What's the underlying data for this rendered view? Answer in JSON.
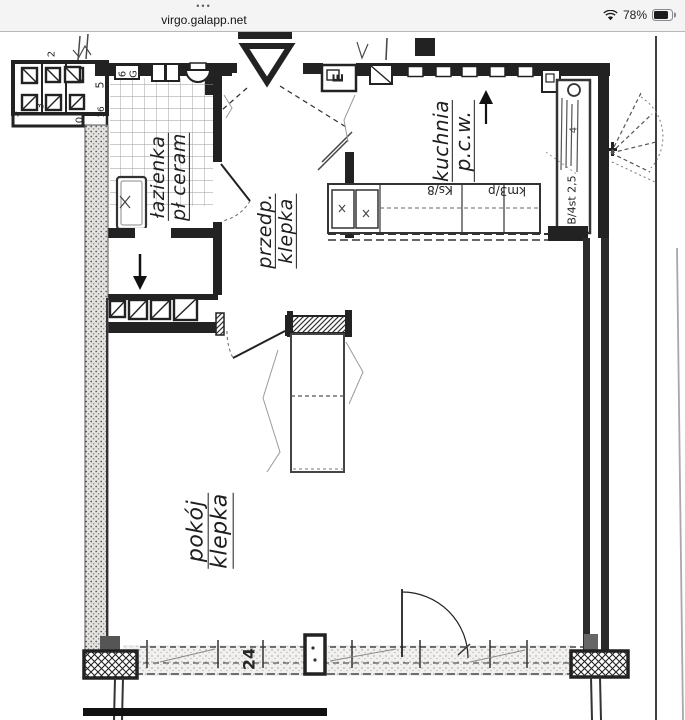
{
  "status_bar": {
    "menu_dots": "•••",
    "url": "virgo.galapp.net",
    "battery_percent": "78%"
  },
  "floor_plan": {
    "rooms": {
      "bathroom": {
        "line1": "łazienka",
        "line2": "pł ceram"
      },
      "hallway": {
        "line1": "przedp.",
        "line2": "klepka"
      },
      "kitchen": {
        "line1": "kuchnia",
        "line2": "p.c.w."
      },
      "living_room": {
        "line1": "pokój",
        "line2": "klepka"
      }
    },
    "annotations": {
      "counter_label_1": "Ks/8",
      "counter_label_2": "km3/p",
      "right_counter_label": "B/4st 2,5",
      "counter_digit": "4",
      "dim_bottom": "24",
      "meter_box": "E",
      "shaft_digits": {
        "d0": "2",
        "d1": "5",
        "d2": "3",
        "d3": "5",
        "d4": "0",
        "d5": "16"
      },
      "fixture_digits": {
        "f2": "6",
        "f3": "G"
      }
    },
    "ink_color": "#222222",
    "paper_color": "#ffffff"
  }
}
